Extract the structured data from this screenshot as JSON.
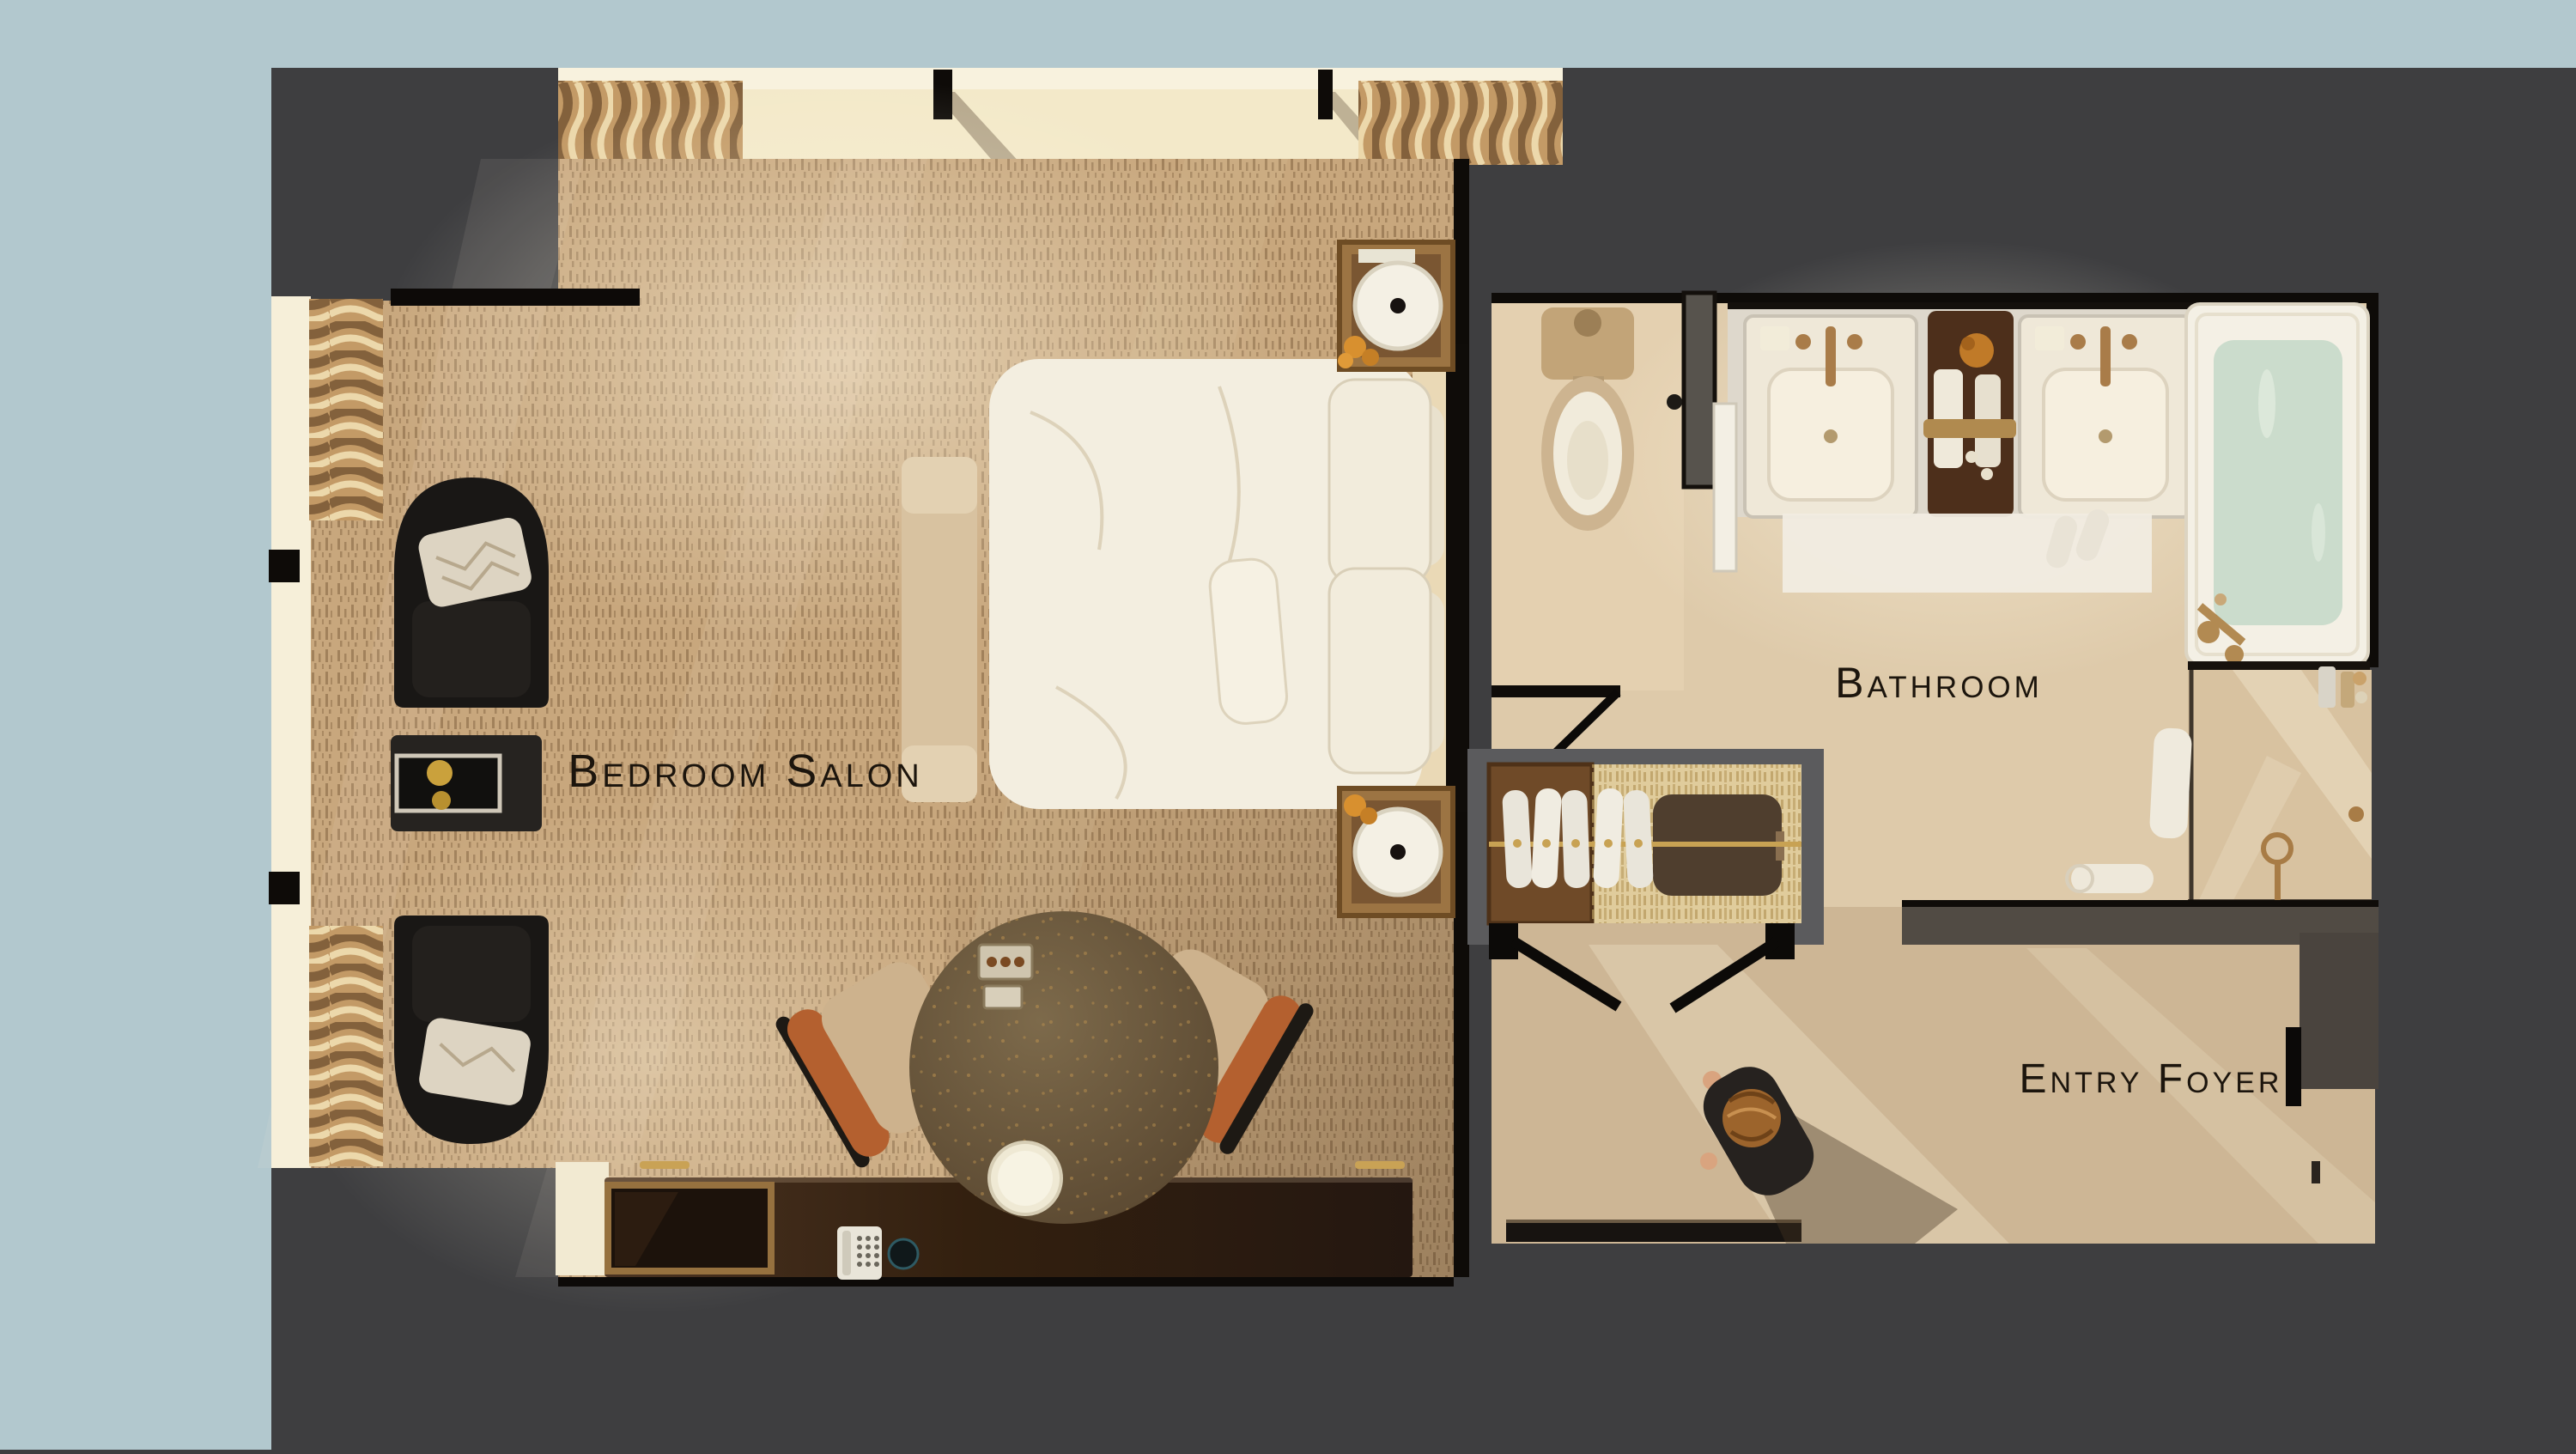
{
  "scene": {
    "type": "hotel-suite-floor-plan-top-down-render",
    "rooms": [
      {
        "name": "bedroom-salon",
        "label": "Bedroom Salon"
      },
      {
        "name": "bathroom",
        "label": "Bathroom"
      },
      {
        "name": "entry-foyer",
        "label": "Entry Foyer"
      }
    ],
    "furnishings": {
      "bedroom_salon": [
        "king bed with white duvet and pillows",
        "upholstered foot bench",
        "two nightstands with drum lamps and orange roses",
        "two black tub chairs with patterned pillows",
        "black side table with gold tray",
        "oval stone table with two dining chairs",
        "media credenza with TV, telephone and round speaker",
        "sheer window drapes"
      ],
      "bathroom": [
        "toilet",
        "double-sink vanity with amenity tray",
        "soaking bathtub with water",
        "walk-in glass shower",
        "white bath mat with slippers",
        "rolled towel"
      ],
      "entry_foyer": [
        "wardrobe closet with robes, rod and luggage bench",
        "double closet doors",
        "entry door threshold",
        "person walking"
      ]
    },
    "colors": {
      "backdrop": "#3e3e40",
      "matting": "#b2c8ce",
      "carpet": "#c8a77d",
      "bath_floor": "#decaaa",
      "foyer_floor": "#cdb695",
      "wall_black": "#0e0b08",
      "wall_gray": "#5b5b5d",
      "linens_white": "#f3eee0",
      "wood_dark": "#2e1d12",
      "accent_gold": "#c9a255",
      "tub_water": "#cbdccc",
      "label_ink": "#1c150d"
    }
  }
}
